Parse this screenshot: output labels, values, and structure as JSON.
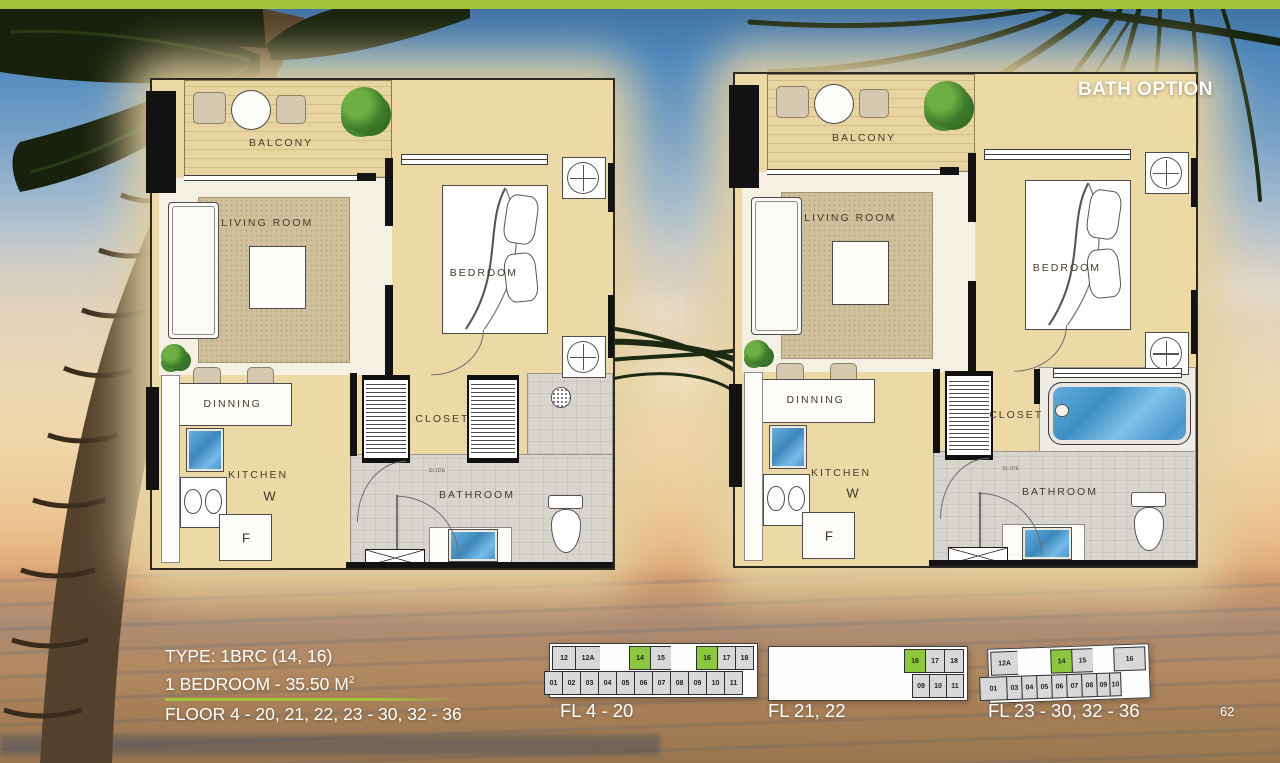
{
  "page": {
    "number": "62"
  },
  "bath_option_label": "BATH OPTION",
  "info": {
    "type_line": "TYPE: 1BRC (14, 16)",
    "area_line": "1 BEDROOM - 35.50 M",
    "area_sup": "2",
    "floor_line": "FLOOR 4 - 20, 21, 22, 23 - 30, 32 - 36"
  },
  "plans": [
    {
      "variant": "standard",
      "labels": {
        "balcony": "BALCONY",
        "living": "LIVING ROOM",
        "bedroom": "BEDROOM",
        "dinning": "DINNING",
        "kitchen": "KITCHEN",
        "washer": "W",
        "fridge": "F",
        "closet": "CLOSET",
        "bathroom": "BATHROOM",
        "slide": "SLIDE"
      }
    },
    {
      "variant": "bath-option",
      "labels": {
        "balcony": "BALCONY",
        "living": "LIVING ROOM",
        "bedroom": "BEDROOM",
        "dinning": "DINNING",
        "kitchen": "KITCHEN",
        "washer": "W",
        "fridge": "F",
        "closet": "CLOSET",
        "bathroom": "BATHROOM",
        "slide": "SLIDE"
      }
    }
  ],
  "key_plans": [
    {
      "caption": "FL 4 - 20",
      "rows": [
        [
          {
            "t": "12",
            "w": 24
          },
          {
            "t": "12A",
            "w": 26
          },
          {
            "gap": true,
            "w": 30
          },
          {
            "t": "14",
            "w": 22,
            "hl": true
          },
          {
            "t": "15",
            "w": 22
          },
          {
            "gap": true,
            "w": 26
          },
          {
            "t": "16",
            "w": 22,
            "hl": true
          },
          {
            "t": "17",
            "w": 19
          },
          {
            "t": "18",
            "w": 19
          }
        ],
        [
          {
            "t": "01",
            "w": 19
          },
          {
            "t": "02",
            "w": 19
          },
          {
            "t": "03",
            "w": 19
          },
          {
            "t": "04",
            "w": 19
          },
          {
            "t": "05",
            "w": 19
          },
          {
            "t": "06",
            "w": 19
          },
          {
            "t": "07",
            "w": 19
          },
          {
            "t": "08",
            "w": 19
          },
          {
            "t": "09",
            "w": 19
          },
          {
            "t": "10",
            "w": 19
          },
          {
            "t": "11",
            "w": 19
          }
        ]
      ]
    },
    {
      "caption": "FL 21, 22",
      "rows": [
        [
          {
            "gap": true,
            "flex": 1
          },
          {
            "t": "16",
            "w": 22,
            "hl": true
          },
          {
            "t": "17",
            "w": 20
          },
          {
            "t": "18",
            "w": 20
          }
        ],
        [
          {
            "gap": true,
            "flex": 1
          },
          {
            "t": "09",
            "w": 18
          },
          {
            "t": "10",
            "w": 18
          },
          {
            "t": "11",
            "w": 18
          }
        ]
      ]
    },
    {
      "caption": "FL 23 - 30, 32 - 36",
      "rows": [
        [
          {
            "t": "12A",
            "w": 28
          },
          {
            "gap": true,
            "w": 34
          },
          {
            "t": "14",
            "w": 22,
            "hl": true
          },
          {
            "t": "15",
            "w": 22
          },
          {
            "gap": true,
            "w": 22
          },
          {
            "t": "16",
            "w": 32
          }
        ],
        [
          {
            "t": "01",
            "w": 28
          },
          {
            "t": "03",
            "w": 16
          },
          {
            "t": "04",
            "w": 16
          },
          {
            "t": "05",
            "w": 16
          },
          {
            "t": "06",
            "w": 16
          },
          {
            "t": "07",
            "w": 16
          },
          {
            "t": "08",
            "w": 16
          },
          {
            "t": "09",
            "w": 14
          },
          {
            "t": "10",
            "w": 12
          }
        ]
      ]
    }
  ],
  "colors": {
    "brand-green": "#a3c53a",
    "unit-green": "#8dc63f",
    "unit-gray": "#d8d8d8"
  }
}
